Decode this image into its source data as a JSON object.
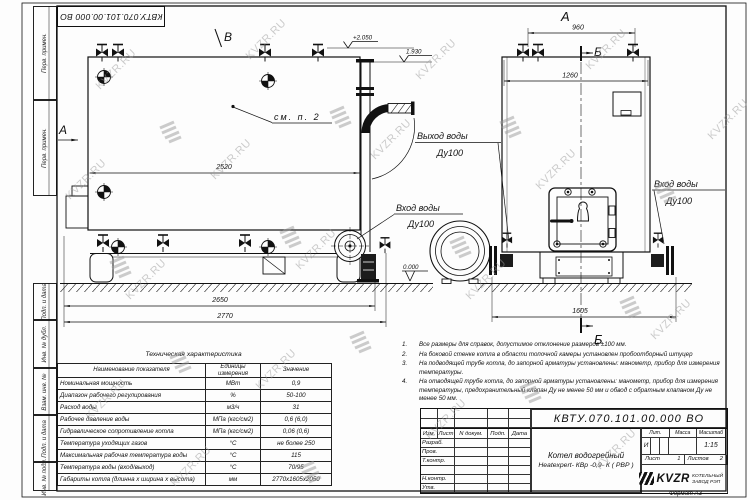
{
  "sheet": {
    "watermark": "KVZR.RU",
    "doc_number": "КВТУ.070.101.00.000  ВО",
    "format": "Формат  А3"
  },
  "margin": {
    "col1": "Перв. примен.",
    "col2": "Перв. примен.",
    "col3": "Подп. и дата",
    "col4": "Инв. № дубл.",
    "col5": "Взам. инв. №",
    "col6": "Подп. и дата",
    "col7": "Инв. № подл."
  },
  "views": {
    "a_side": "А",
    "a_top": "А",
    "b_top": "Б",
    "b_bottom": "Б",
    "v_label": "В",
    "see_note": "см. п. 2"
  },
  "dims": {
    "d2520": "2520",
    "d2650": "2650",
    "d2770": "2770",
    "d960": "960",
    "d1260": "1260",
    "d1605": "1605",
    "e2050": "+2.050",
    "e1930": "1.930",
    "e0000": "0.000"
  },
  "callouts": {
    "out1": "Выход воды",
    "out2": "Ду100",
    "in1": "Вход воды",
    "in2": "Ду100",
    "inr1": "Вход воды",
    "inr2": "Ду100"
  },
  "spec_table": {
    "title": "Техническая характеристика",
    "headers": [
      "Наименование показателя",
      "Единицы измерения",
      "Значение"
    ],
    "rows": [
      [
        "Номинальная мощность",
        "МВт",
        "0,9"
      ],
      [
        "Диапазон рабочего регулирования",
        "%",
        "50-100"
      ],
      [
        "Расход воды",
        "м3/ч",
        "31"
      ],
      [
        "Рабочее давление воды",
        "МПа (кгс/см2)",
        "0,6 (6,0)"
      ],
      [
        "Гидравлическое сопротивление котла",
        "МПа (кгс/см2)",
        "0,06 (0,6)"
      ],
      [
        "Температура уходящих газов",
        "°С",
        "не более 250"
      ],
      [
        "Максимальная рабочая температура воды",
        "°С",
        "115"
      ],
      [
        "Температура воды (вход/выход)",
        "°С",
        "70/95"
      ],
      [
        "Габариты котла (длинна х ширина х высота)",
        "мм",
        "2770х1605х2050"
      ]
    ]
  },
  "notes": {
    "items": [
      {
        "num": "1.",
        "text": "Все размеры для справок, допустимое отклонение размеров ±100 мм."
      },
      {
        "num": "2.",
        "text": "На боковой стенке котла в области топочной камеры установлен пробоотборный штуцер"
      },
      {
        "num": "3.",
        "text": "На  подводящей трубе котла, до запорной арматуры установлены: манометр, прибор для измерения температуры."
      },
      {
        "num": "4.",
        "text": "На отводящей трубе котла, до запорной арматуры установлены: манометр, прибор для измерения температуры, предохранительный клапан  Ду не менее  50 мм и обвод с обратным клапаном  Ду не менее  50 мм."
      }
    ]
  },
  "title_block": {
    "doc_number": "КВТУ.070.101.00.000  ВО",
    "product_name": "Котел водогрейный",
    "product_type": "Heatexpert- КВр -0,9- К ( РВР )",
    "col_izm": "Изм.",
    "col_list": "Лист",
    "col_ndoc": "N докум.",
    "col_podp": "Подп.",
    "col_data": "Дата",
    "row_razrab": "Разраб.",
    "row_prov": "Пров.",
    "row_tkontr": "Т.контр.",
    "row_nkontr": "Н.контр.",
    "row_utv": "Утв.",
    "lit": "Лит.",
    "massa": "Масса",
    "masshtab": "Масштаб",
    "lit_val": "И",
    "scale_val": "1:15",
    "list_label": "Лист",
    "list_val": "1",
    "listov_label": "Листов",
    "listov_val": "2",
    "logo_text": "KVZR",
    "company1": "КОТЕЛЬНЫЙ",
    "company2": "ЗАВОД РЭП"
  }
}
